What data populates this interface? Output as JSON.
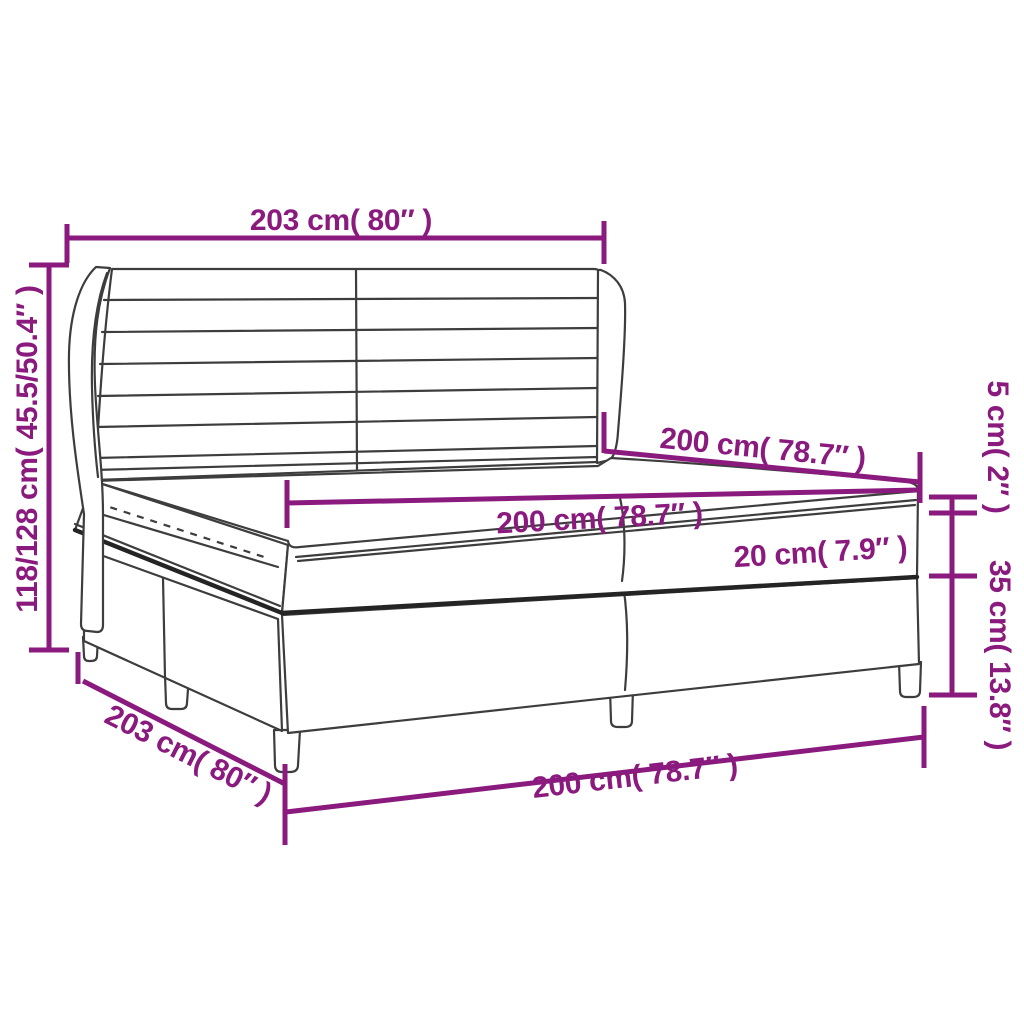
{
  "title": "Box spring bed with winged headboard — dimension diagram",
  "colors": {
    "dimension_accent": "#8A1A7E",
    "outline": "#3D3D3D",
    "background": "#FFFFFF"
  },
  "labels": {
    "headboard_width": "203 cm( 80″ )",
    "overall_height": "118/128 cm( 45.5/50.4″ )",
    "mattress_length": "200 cm( 78.7″ )",
    "mattress_width": "200 cm( 78.7″ )",
    "topper_height": "5 cm( 2″ )",
    "mattress_height": "20 cm( 7.9″ )",
    "base_height": "35 cm( 13.8″ )",
    "frame_length": "203 cm( 80″ )",
    "bed_width": "200 cm( 78.7″ )"
  }
}
